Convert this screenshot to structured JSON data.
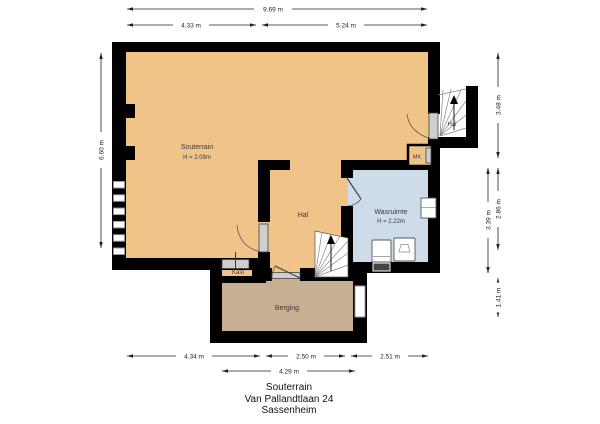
{
  "title_block": {
    "floor": "Souterrain",
    "address": "Van Pallandtlaan 24",
    "city": "Sassenheim"
  },
  "rooms": {
    "souterrain": {
      "name": "Souterrain",
      "height": "H = 2.09m"
    },
    "hal": {
      "name": "Hal"
    },
    "wasruimte": {
      "name": "Wasruimte",
      "height": "H = 2.22m"
    },
    "kast": {
      "name": "Kast"
    },
    "berging": {
      "name": "Berging"
    },
    "hal_boven": {
      "name": "Hal"
    },
    "meterkast": {
      "name": "MK"
    }
  },
  "dimensions": {
    "top_total": "9.69 m",
    "top_left": "4.33 m",
    "top_right": "5.24 m",
    "left_side": "6.60 m",
    "right_top": "3.48 m",
    "right_mid_inner": "3.39 m",
    "right_mid_outer": "2.86 m",
    "right_bottom": "1.41 m",
    "bottom_left": "4.34 m",
    "bottom_middle": "2.50 m",
    "bottom_right": "2.51 m",
    "bottom_inner": "4.29 m"
  },
  "colors": {
    "floor_main": "#F0C389",
    "floor_storage": "#C7AF94",
    "floor_laundry": "#CEDCE9",
    "wall": "#000000",
    "dimension_text": "#222222"
  }
}
